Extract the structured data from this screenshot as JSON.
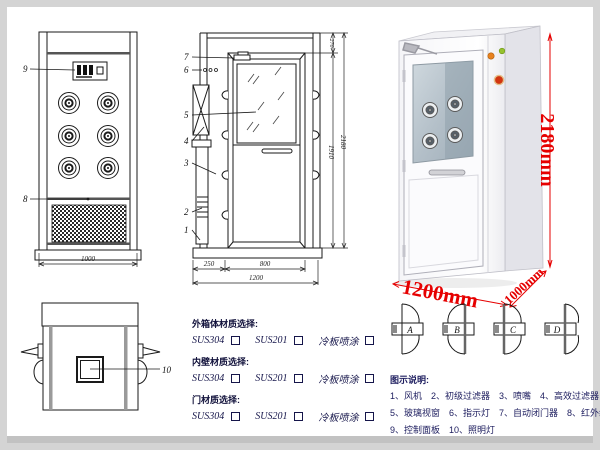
{
  "drawings": {
    "front_view": {
      "part_labels": {
        "control_panel": "9",
        "fan_grille": "8"
      },
      "width_dim": "1000"
    },
    "side_view": {
      "part_labels": [
        "7",
        "6",
        "5",
        "4",
        "3",
        "2",
        "1"
      ],
      "dims": {
        "top_section": "270",
        "door_height": "1910",
        "total_height": "2180",
        "bottom_front": "250",
        "bottom_door": "800",
        "bottom_total": "1200"
      }
    },
    "top_view": {
      "part_labels": {
        "lamp": "10"
      }
    }
  },
  "product_photo": {
    "dims": {
      "height": "2180mm",
      "width": "1200mm",
      "depth": "1000mm"
    },
    "dim_color": "#e60000"
  },
  "door_options": {
    "items": [
      {
        "label": "A"
      },
      {
        "label": "B"
      },
      {
        "label": "C"
      },
      {
        "label": "D"
      }
    ]
  },
  "materials": {
    "sections": [
      {
        "title": "外箱体材质选择:",
        "options": [
          "SUS304",
          "SUS201",
          "冷板喷涂"
        ]
      },
      {
        "title": "内壁材质选择:",
        "options": [
          "SUS304",
          "SUS201",
          "冷板喷涂"
        ]
      },
      {
        "title": "门材质选择:",
        "options": [
          "SUS304",
          "SUS201",
          "冷板喷涂"
        ]
      }
    ]
  },
  "legend": {
    "title": "图示说明:",
    "rows": [
      [
        "1、风机",
        "2、初级过滤器",
        "3、喷嘴",
        "4、高效过滤器"
      ],
      [
        "5、玻璃视窗",
        "6、指示灯",
        "7、自动闭门器",
        "8、红外线感应器"
      ],
      [
        "9、控制面板",
        "10、照明灯"
      ]
    ]
  }
}
